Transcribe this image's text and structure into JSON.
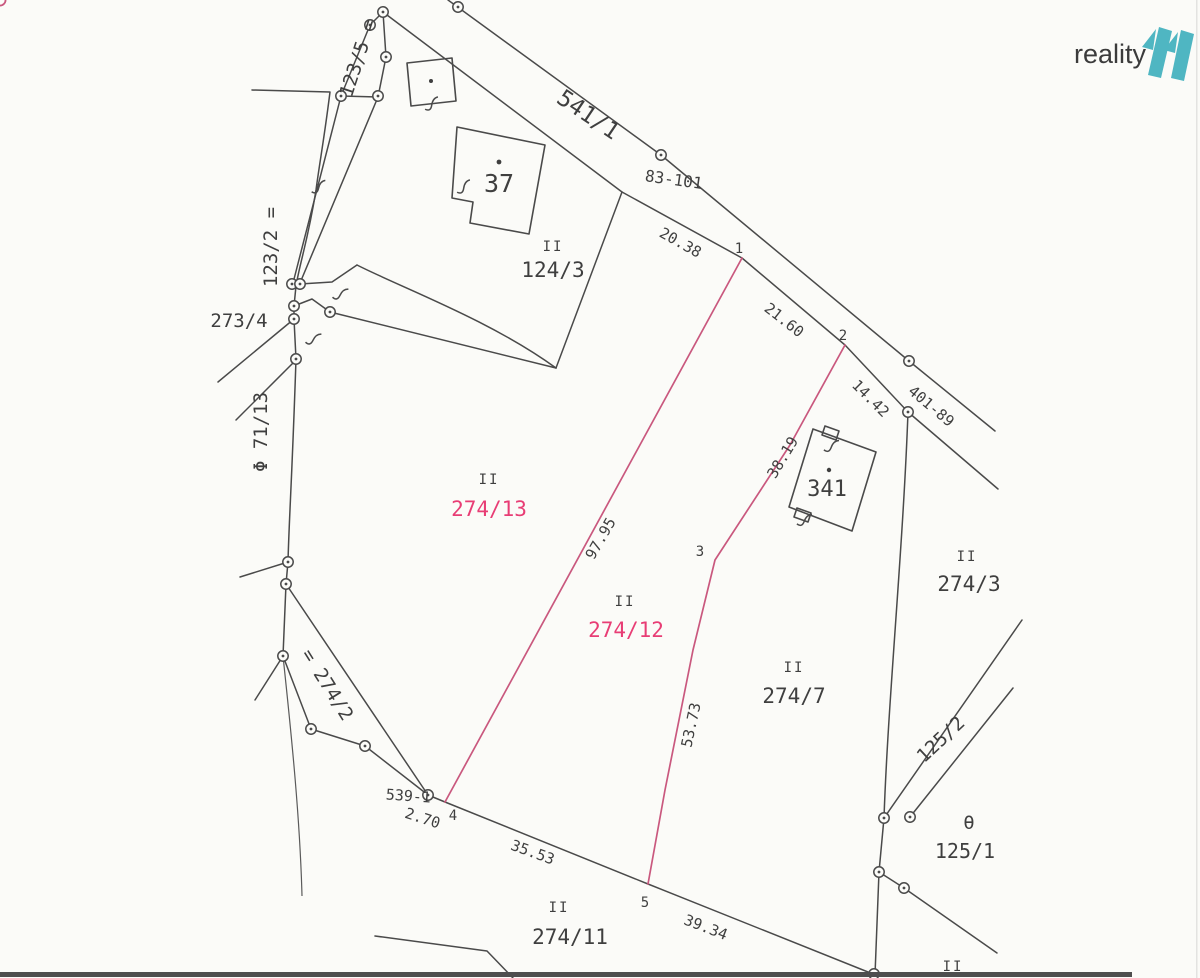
{
  "logo": {
    "text": "reality",
    "mark": "11",
    "mark_color": "#4fb6c2",
    "text_color": "#3b3b3b"
  },
  "colors": {
    "ink": "#3f3f3f",
    "line": "#4a4a4a",
    "pink_line": "#c9587e",
    "pink_text": "#e83d75",
    "paper": "#fbfbf8"
  },
  "parcels": [
    {
      "id": "123/5",
      "label": "123/5 ="
    },
    {
      "id": "123/2",
      "label": "123/2 ="
    },
    {
      "id": "273/4",
      "label": "273/4"
    },
    {
      "id": "71/13",
      "label": "Φ 71/13"
    },
    {
      "id": "274/2",
      "label": "= 274/2"
    },
    {
      "id": "124/3",
      "label": "124/3",
      "symbol": "II"
    },
    {
      "id": "274/13",
      "label": "274/13",
      "symbol": "II",
      "highlight": true
    },
    {
      "id": "274/12",
      "label": "274/12",
      "symbol": "II",
      "highlight": true
    },
    {
      "id": "274/7",
      "label": "274/7",
      "symbol": "II"
    },
    {
      "id": "274/3",
      "label": "274/3",
      "symbol": "II"
    },
    {
      "id": "274/11",
      "label": "274/11",
      "symbol": "II"
    },
    {
      "id": "125/1",
      "label": "125/1",
      "symbol": "θ"
    },
    {
      "id": "125/2",
      "label": "125/2"
    },
    {
      "id": "541/1",
      "label": "541/1"
    }
  ],
  "buildings": [
    {
      "number": "37"
    },
    {
      "number": "341"
    }
  ],
  "survey_marks": [
    {
      "label": "83-101"
    },
    {
      "label": "401-89"
    },
    {
      "label": "539-1"
    }
  ],
  "measurements": [
    {
      "value": "20.38"
    },
    {
      "value": "21.60"
    },
    {
      "value": "14.42"
    },
    {
      "value": "38.19"
    },
    {
      "value": "97.95"
    },
    {
      "value": "53.73"
    },
    {
      "value": "2.70"
    },
    {
      "value": "35.53"
    },
    {
      "value": "39.34"
    }
  ],
  "points": [
    {
      "n": "1"
    },
    {
      "n": "2"
    },
    {
      "n": "3"
    },
    {
      "n": "4"
    },
    {
      "n": "5"
    }
  ],
  "map_extras": {
    "bottom_right_symbol": "II"
  }
}
